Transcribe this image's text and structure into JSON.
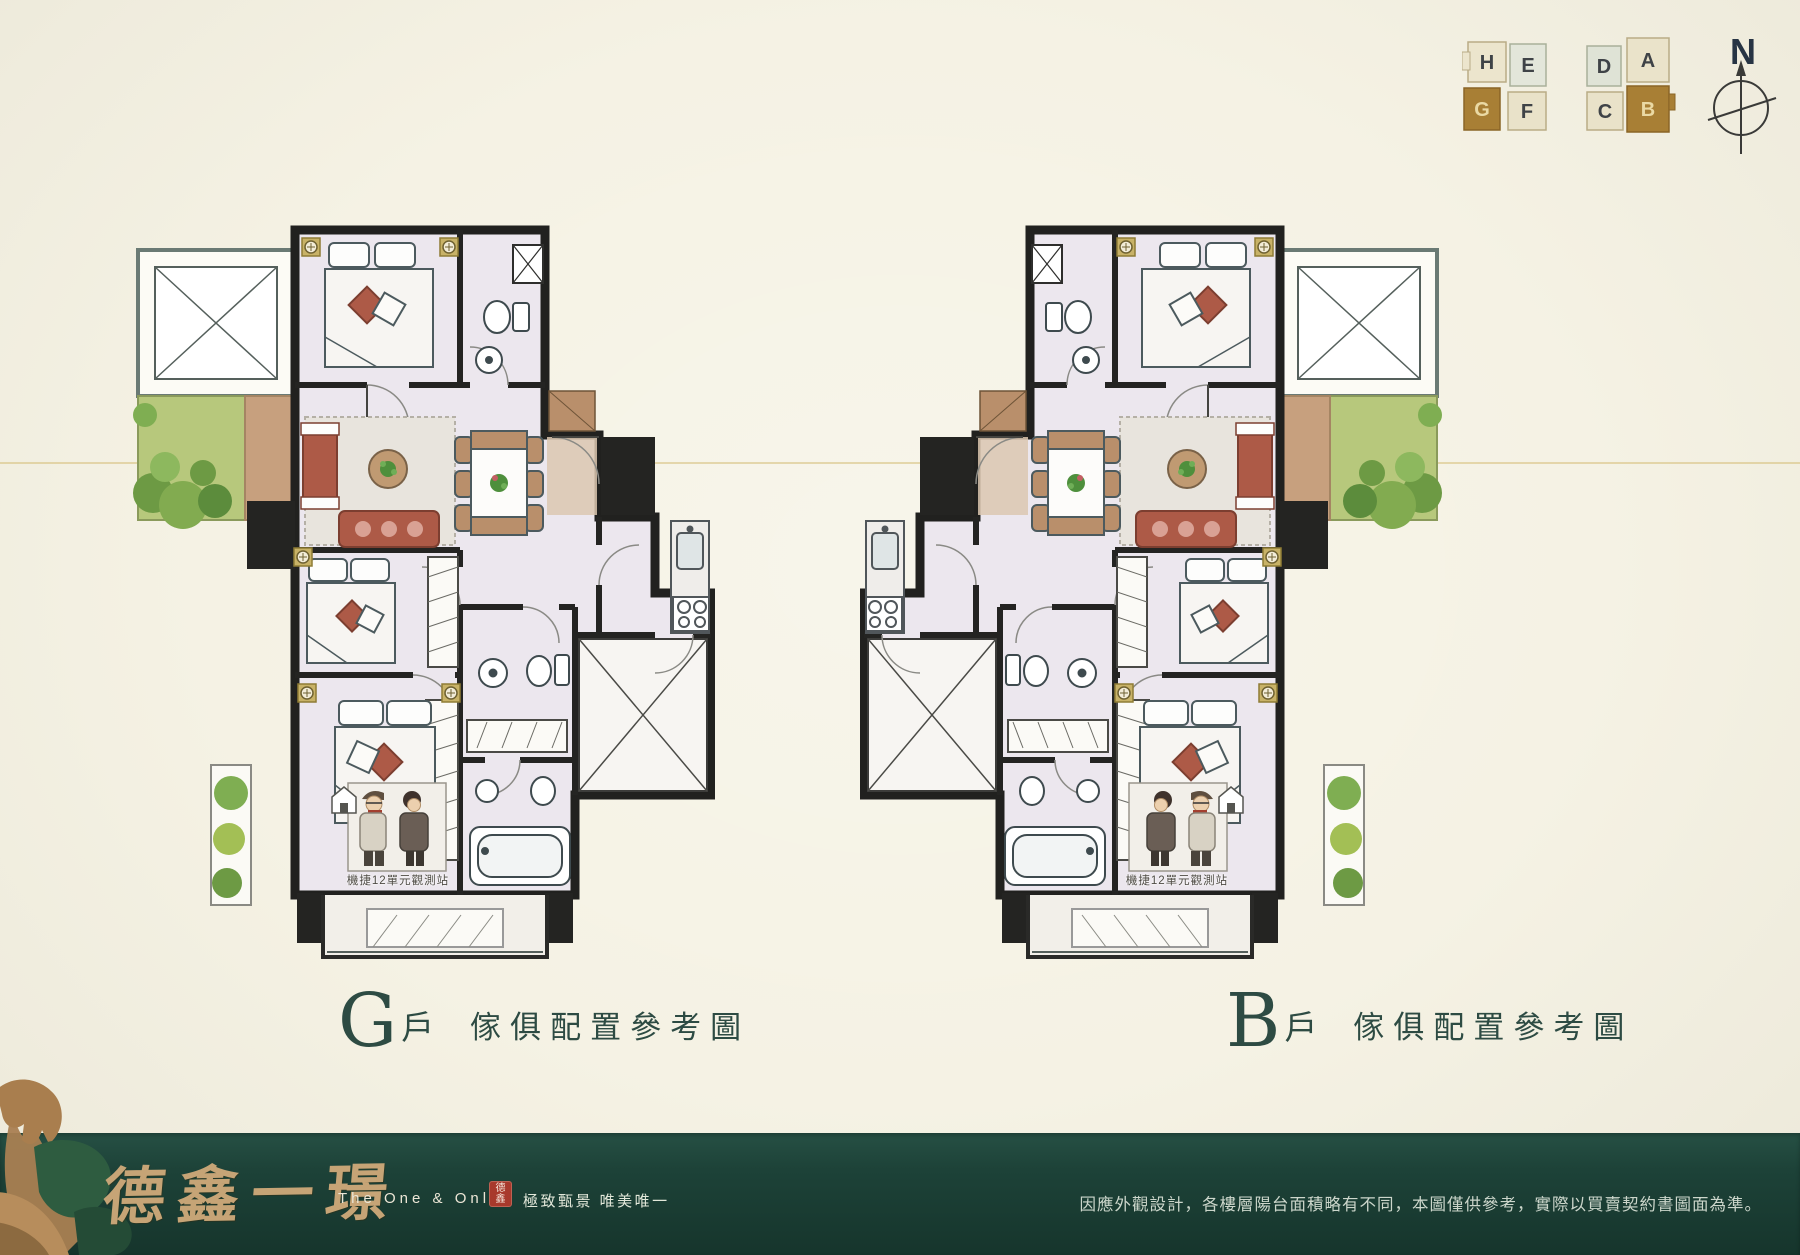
{
  "page": {
    "background_color": "#f5f2e4",
    "scanline_color": "#d6be78"
  },
  "key_plans": {
    "left_building": {
      "units": [
        {
          "label": "H",
          "highlight": false
        },
        {
          "label": "E",
          "highlight": false
        },
        {
          "label": "G",
          "highlight": true
        },
        {
          "label": "F",
          "highlight": false
        }
      ],
      "highlight_color": "#a87f35"
    },
    "right_building": {
      "units": [
        {
          "label": "D",
          "highlight": false
        },
        {
          "label": "A",
          "highlight": false
        },
        {
          "label": "C",
          "highlight": false
        },
        {
          "label": "B",
          "highlight": true
        }
      ],
      "highlight_color": "#a87f35"
    }
  },
  "compass": {
    "north_label": "N"
  },
  "plans": [
    {
      "unit": "G",
      "suffix": "戶",
      "caption": "傢俱配置參考圖",
      "annotation": "機捷12單元觀測站"
    },
    {
      "unit": "B",
      "suffix": "戶",
      "caption": "傢俱配置參考圖",
      "annotation": "機捷12單元觀測站"
    }
  ],
  "footer": {
    "brand": "德鑫一璟",
    "brand_en": "The One & Only",
    "seal_line1": "德",
    "seal_line2": "鑫",
    "tagline": "極致甄景 唯美唯一",
    "disclaimer": "因應外觀設計，各樓層陽台面積略有不同，本圖僅供參考，實際以買賣契約書圖面為準。",
    "band_color": "#1d4238",
    "brand_color": "#c6a476"
  }
}
